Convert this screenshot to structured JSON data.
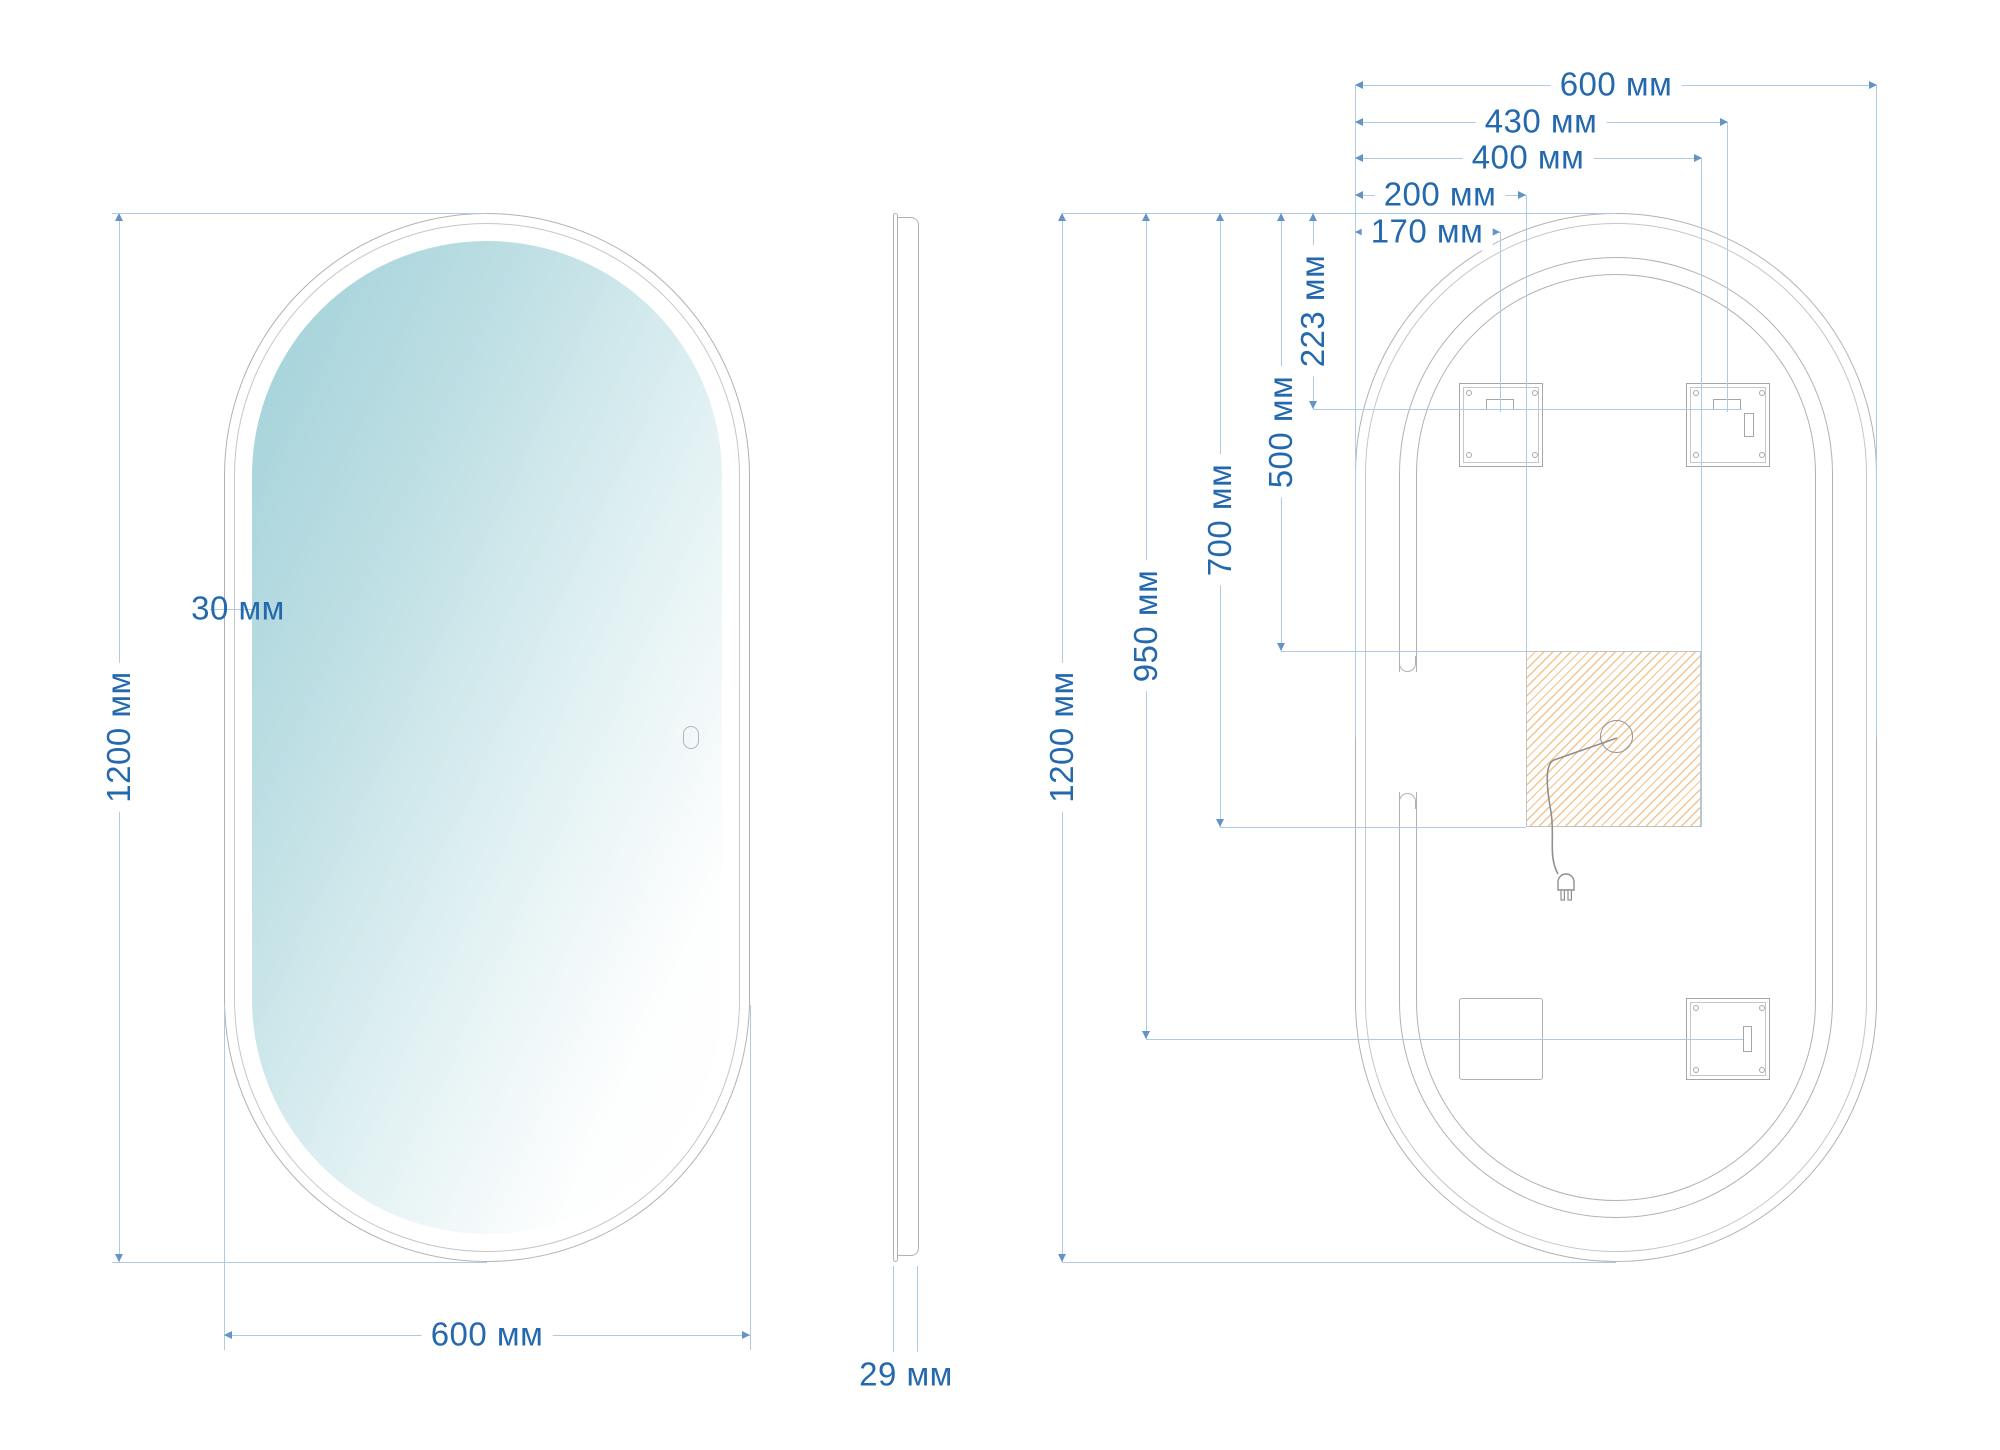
{
  "drawing": {
    "description": "Technical dimension drawing of an oval (capsule) LED bathroom mirror: front view, side profile view and rear mounting view",
    "units": "мм",
    "front": {
      "height_label": "1200 мм",
      "width_label": "600 мм",
      "frame_width_label": "30 мм"
    },
    "side": {
      "thickness_label": "29 мм"
    },
    "back": {
      "top_dimensions": [
        {
          "id": "overall-width",
          "label": "600 мм"
        },
        {
          "id": "right-bracket-slot",
          "label": "430 мм"
        },
        {
          "id": "driver-zone-right",
          "label": "400 мм"
        },
        {
          "id": "driver-zone-left",
          "label": "200 мм"
        },
        {
          "id": "left-bracket-slot",
          "label": "170 мм"
        }
      ],
      "left_dimensions": [
        {
          "id": "overall-height",
          "label": "1200 мм"
        },
        {
          "id": "bottom-bracket-slot",
          "label": "950 мм"
        },
        {
          "id": "driver-zone-bottom",
          "label": "700 мм"
        },
        {
          "id": "driver-zone-top",
          "label": "500 мм"
        },
        {
          "id": "top-bracket-slot",
          "label": "223 мм"
        }
      ]
    },
    "colors": {
      "dimension_text": "#2469ad",
      "dimension_line": "#adcbe4",
      "outline_gray": "#b2b2b2",
      "hatch_orange": "#f1c490",
      "mirror_tint": "#9fd0d8"
    }
  }
}
